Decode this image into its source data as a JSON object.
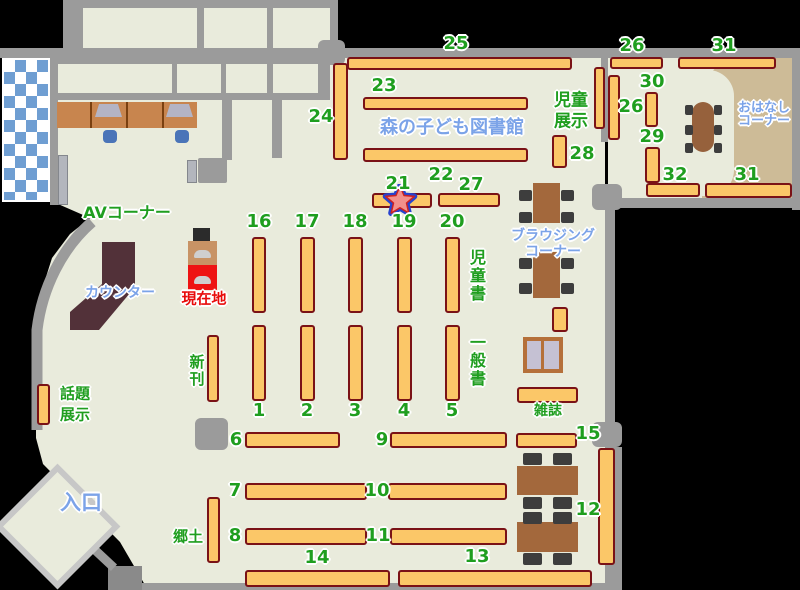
{
  "map": {
    "title": "森の子ども図書館",
    "colors": {
      "floor": "#e9ebdc",
      "wall": "#9b9b9b",
      "shelf_fill": "#fbc768",
      "shelf_border": "#7a1216",
      "label_green": "#1f9e1f",
      "label_blue": "#7ba3e8",
      "label_red": "#e80c0c",
      "table_brown": "#a3683c",
      "chair_dark": "#3d3d3d",
      "story_tan": "#cdbb97",
      "counter_brown": "#523139",
      "desk_tan": "#c8854e",
      "window_blue": "#6f9ed2",
      "star_fill": "#f2908b",
      "star_outline": "#2743cf",
      "kiosk_red": "#ee1313",
      "kiosk_tan": "#c89365",
      "chair_blue": "#4a74b8",
      "sofa_fill": "#c5c1d3",
      "sofa_border": "#b5703a",
      "entrance_border": "#c7c7c7"
    },
    "areas": {
      "av_corner": "AVコーナー",
      "counter": "カウンター",
      "current_location": "現在地",
      "new_books": "新刊",
      "topic_display": "話題展示",
      "entrance": "入口",
      "local": "郷土",
      "children_books": "児童書",
      "general_books": "一般書",
      "magazines": "雑誌",
      "browsing_corner": "ブラウジングコーナー",
      "children_display": "児童展示",
      "story_corner": "おはなしコーナー"
    },
    "shelves": [
      {
        "n": "25",
        "x": 347,
        "y": 57,
        "w": 225,
        "h": 13
      },
      {
        "n": "23",
        "x": 363,
        "y": 97,
        "w": 165,
        "h": 13
      },
      {
        "n": "22",
        "x": 363,
        "y": 148,
        "w": 165,
        "h": 14
      },
      {
        "n": "21",
        "x": 372,
        "y": 193,
        "w": 60,
        "h": 15
      },
      {
        "n": "27",
        "x": 438,
        "y": 193,
        "w": 62,
        "h": 14
      },
      {
        "n": "24",
        "x": 333,
        "y": 63,
        "w": 15,
        "h": 97
      },
      {
        "n": "16",
        "x": 252,
        "y": 237,
        "w": 14,
        "h": 76
      },
      {
        "n": "17",
        "x": 300,
        "y": 237,
        "w": 15,
        "h": 76
      },
      {
        "n": "18",
        "x": 348,
        "y": 237,
        "w": 15,
        "h": 76
      },
      {
        "n": "19",
        "x": 397,
        "y": 237,
        "w": 15,
        "h": 76
      },
      {
        "n": "20",
        "x": 445,
        "y": 237,
        "w": 15,
        "h": 76
      },
      {
        "n": "1",
        "x": 252,
        "y": 325,
        "w": 14,
        "h": 76
      },
      {
        "n": "2",
        "x": 300,
        "y": 325,
        "w": 15,
        "h": 76
      },
      {
        "n": "3",
        "x": 348,
        "y": 325,
        "w": 15,
        "h": 76
      },
      {
        "n": "4",
        "x": 397,
        "y": 325,
        "w": 15,
        "h": 76
      },
      {
        "n": "5",
        "x": 445,
        "y": 325,
        "w": 15,
        "h": 76
      },
      {
        "n": "6",
        "x": 245,
        "y": 432,
        "w": 95,
        "h": 16
      },
      {
        "n": "9",
        "x": 390,
        "y": 432,
        "w": 117,
        "h": 16
      },
      {
        "n": "7",
        "x": 245,
        "y": 483,
        "w": 122,
        "h": 17
      },
      {
        "n": "10",
        "x": 388,
        "y": 483,
        "w": 119,
        "h": 17
      },
      {
        "n": "8",
        "x": 245,
        "y": 528,
        "w": 122,
        "h": 17
      },
      {
        "n": "11",
        "x": 390,
        "y": 528,
        "w": 117,
        "h": 17
      },
      {
        "n": "14",
        "x": 245,
        "y": 570,
        "w": 145,
        "h": 17
      },
      {
        "n": "13",
        "x": 398,
        "y": 570,
        "w": 194,
        "h": 17
      },
      {
        "n": "15",
        "x": 516,
        "y": 433,
        "w": 61,
        "h": 15
      },
      {
        "n": "12",
        "x": 598,
        "y": 448,
        "w": 17,
        "h": 117
      },
      {
        "n": "26h",
        "x": 610,
        "y": 57,
        "w": 53,
        "h": 12
      },
      {
        "n": "31t",
        "x": 678,
        "y": 57,
        "w": 98,
        "h": 12
      },
      {
        "n": "26v",
        "x": 608,
        "y": 75,
        "w": 12,
        "h": 65
      },
      {
        "n": "30",
        "x": 645,
        "y": 92,
        "w": 13,
        "h": 35
      },
      {
        "n": "29",
        "x": 645,
        "y": 147,
        "w": 15,
        "h": 36
      },
      {
        "n": "28",
        "x": 552,
        "y": 135,
        "w": 15,
        "h": 33
      },
      {
        "n": "32",
        "x": 646,
        "y": 183,
        "w": 54,
        "h": 14
      },
      {
        "n": "31b",
        "x": 705,
        "y": 183,
        "w": 87,
        "h": 15
      },
      {
        "n": "new-books",
        "x": 207,
        "y": 335,
        "w": 12,
        "h": 67
      },
      {
        "n": "topic-display",
        "x": 37,
        "y": 384,
        "w": 13,
        "h": 41
      },
      {
        "n": "local",
        "x": 207,
        "y": 497,
        "w": 13,
        "h": 66
      },
      {
        "n": "children-display",
        "x": 594,
        "y": 67,
        "w": 11,
        "h": 62
      },
      {
        "n": "magazines",
        "x": 517,
        "y": 387,
        "w": 61,
        "h": 16
      },
      {
        "n": "browsing-small",
        "x": 552,
        "y": 307,
        "w": 16,
        "h": 25
      }
    ],
    "labels": [
      {
        "name": "map-title",
        "t": "森の子ども図書館",
        "x": 452,
        "y": 128,
        "c": "b",
        "fs": 18
      },
      {
        "name": "shelf-number-25",
        "t": "25",
        "x": 456,
        "y": 44,
        "c": "g",
        "fs": 18
      },
      {
        "name": "shelf-number-23",
        "t": "23",
        "x": 384,
        "y": 86,
        "c": "g",
        "fs": 18
      },
      {
        "name": "shelf-number-24",
        "t": "24",
        "x": 321,
        "y": 117,
        "c": "g",
        "fs": 18
      },
      {
        "name": "shelf-number-22",
        "t": "22",
        "x": 441,
        "y": 175,
        "c": "g",
        "fs": 18
      },
      {
        "name": "shelf-number-21",
        "t": "21",
        "x": 398,
        "y": 184,
        "c": "g",
        "fs": 18
      },
      {
        "name": "shelf-number-27",
        "t": "27",
        "x": 471,
        "y": 185,
        "c": "g",
        "fs": 18
      },
      {
        "name": "shelf-number-26-top",
        "t": "26",
        "x": 632,
        "y": 46,
        "c": "g",
        "fs": 18
      },
      {
        "name": "shelf-number-31-top",
        "t": "31",
        "x": 724,
        "y": 46,
        "c": "g",
        "fs": 18
      },
      {
        "name": "shelf-number-30",
        "t": "30",
        "x": 652,
        "y": 82,
        "c": "g",
        "fs": 18
      },
      {
        "name": "shelf-number-26-side",
        "t": "26",
        "x": 631,
        "y": 107,
        "c": "g",
        "fs": 18
      },
      {
        "name": "shelf-number-29",
        "t": "29",
        "x": 652,
        "y": 137,
        "c": "g",
        "fs": 18
      },
      {
        "name": "shelf-number-28",
        "t": "28",
        "x": 582,
        "y": 154,
        "c": "g",
        "fs": 18
      },
      {
        "name": "shelf-number-32",
        "t": "32",
        "x": 675,
        "y": 175,
        "c": "g",
        "fs": 18
      },
      {
        "name": "shelf-number-31-bottom",
        "t": "31",
        "x": 747,
        "y": 175,
        "c": "g",
        "fs": 18
      },
      {
        "name": "shelf-number-16",
        "t": "16",
        "x": 259,
        "y": 222,
        "c": "g",
        "fs": 18
      },
      {
        "name": "shelf-number-17",
        "t": "17",
        "x": 307,
        "y": 222,
        "c": "g",
        "fs": 18
      },
      {
        "name": "shelf-number-18",
        "t": "18",
        "x": 355,
        "y": 222,
        "c": "g",
        "fs": 18
      },
      {
        "name": "shelf-number-19",
        "t": "19",
        "x": 404,
        "y": 222,
        "c": "g",
        "fs": 18
      },
      {
        "name": "shelf-number-20",
        "t": "20",
        "x": 452,
        "y": 222,
        "c": "g",
        "fs": 18
      },
      {
        "name": "shelf-number-1",
        "t": "1",
        "x": 259,
        "y": 411,
        "c": "g",
        "fs": 18
      },
      {
        "name": "shelf-number-2",
        "t": "2",
        "x": 307,
        "y": 411,
        "c": "g",
        "fs": 18
      },
      {
        "name": "shelf-number-3",
        "t": "3",
        "x": 355,
        "y": 411,
        "c": "g",
        "fs": 18
      },
      {
        "name": "shelf-number-4",
        "t": "4",
        "x": 404,
        "y": 411,
        "c": "g",
        "fs": 18
      },
      {
        "name": "shelf-number-5",
        "t": "5",
        "x": 452,
        "y": 411,
        "c": "g",
        "fs": 18
      },
      {
        "name": "shelf-number-6",
        "t": "6",
        "x": 236,
        "y": 440,
        "c": "g",
        "fs": 18
      },
      {
        "name": "shelf-number-9",
        "t": "9",
        "x": 382,
        "y": 440,
        "c": "g",
        "fs": 18
      },
      {
        "name": "shelf-number-7",
        "t": "7",
        "x": 235,
        "y": 491,
        "c": "g",
        "fs": 18
      },
      {
        "name": "shelf-number-10",
        "t": "10",
        "x": 377,
        "y": 491,
        "c": "g",
        "fs": 18
      },
      {
        "name": "shelf-number-8",
        "t": "8",
        "x": 235,
        "y": 536,
        "c": "g",
        "fs": 18
      },
      {
        "name": "shelf-number-11",
        "t": "11",
        "x": 378,
        "y": 536,
        "c": "g",
        "fs": 18
      },
      {
        "name": "shelf-number-14",
        "t": "14",
        "x": 317,
        "y": 558,
        "c": "g",
        "fs": 18
      },
      {
        "name": "shelf-number-13",
        "t": "13",
        "x": 477,
        "y": 557,
        "c": "g",
        "fs": 18
      },
      {
        "name": "shelf-number-15",
        "t": "15",
        "x": 588,
        "y": 434,
        "c": "g",
        "fs": 18
      },
      {
        "name": "shelf-number-12",
        "t": "12",
        "x": 588,
        "y": 510,
        "c": "g",
        "fs": 18
      },
      {
        "name": "area-label-av-corner",
        "t": "AVコーナー",
        "x": 127,
        "y": 213,
        "c": "g",
        "fs": 16
      },
      {
        "name": "area-label-topic-display-line1",
        "t": "話題",
        "x": 75,
        "y": 394,
        "c": "g",
        "fs": 15
      },
      {
        "name": "area-label-topic-display-line2",
        "t": "展示",
        "x": 75,
        "y": 415,
        "c": "g",
        "fs": 15
      },
      {
        "name": "area-label-new-books",
        "t": "新刊",
        "x": 196,
        "y": 371,
        "c": "g",
        "fs": 15,
        "v": true
      },
      {
        "name": "area-label-local",
        "t": "郷土",
        "x": 188,
        "y": 537,
        "c": "g",
        "fs": 15
      },
      {
        "name": "area-label-children-books",
        "t": "児童書",
        "x": 476,
        "y": 276,
        "c": "g",
        "fs": 16,
        "v": true
      },
      {
        "name": "area-label-general-books",
        "t": "一般書",
        "x": 476,
        "y": 361,
        "c": "g",
        "fs": 16,
        "v": true
      },
      {
        "name": "area-label-magazines",
        "t": "雑誌",
        "x": 548,
        "y": 411,
        "c": "g",
        "fs": 14
      },
      {
        "name": "area-label-children-display-line1",
        "t": "児童",
        "x": 571,
        "y": 101,
        "c": "g",
        "fs": 17
      },
      {
        "name": "area-label-children-display-line2",
        "t": "展示",
        "x": 571,
        "y": 122,
        "c": "g",
        "fs": 17
      },
      {
        "name": "current-location-label",
        "t": "現在地",
        "x": 204,
        "y": 299,
        "c": "r",
        "fs": 15
      },
      {
        "name": "area-label-counter",
        "t": "カウンター",
        "x": 120,
        "y": 293,
        "c": "b",
        "fs": 14
      },
      {
        "name": "area-label-entrance",
        "t": "入口",
        "x": 81,
        "y": 503,
        "c": "b",
        "fs": 21
      },
      {
        "name": "area-label-browsing-line1",
        "t": "ブラウジング",
        "x": 553,
        "y": 236,
        "c": "b",
        "fs": 14
      },
      {
        "name": "area-label-browsing-line2",
        "t": "コーナー",
        "x": 553,
        "y": 252,
        "c": "b",
        "fs": 14
      },
      {
        "name": "area-label-story-corner-line1",
        "t": "おはなし",
        "x": 764,
        "y": 108,
        "c": "b",
        "fs": 13
      },
      {
        "name": "area-label-story-corner-line2",
        "t": "コーナー",
        "x": 764,
        "y": 121,
        "c": "b",
        "fs": 13
      }
    ]
  }
}
